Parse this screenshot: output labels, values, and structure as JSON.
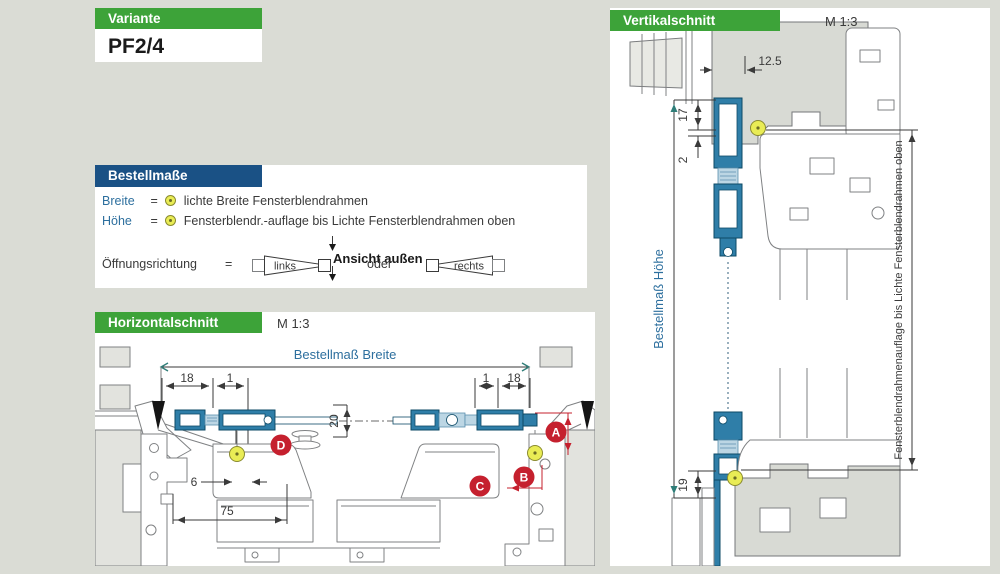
{
  "colors": {
    "page_bg": "#dadcd5",
    "green_header": "#3da339",
    "blue_header": "#1a5185",
    "blue_text": "#2d6f9e",
    "red_badge": "#c5202e",
    "profile_teal": "#2f7ea8",
    "marker_yellow": "#e9ec55"
  },
  "variante": {
    "header": "Variante",
    "value": "PF2/4"
  },
  "bestellmasse": {
    "header": "Bestellmaße",
    "breite_label": "Breite",
    "breite_eq": "=",
    "breite_desc": "lichte Breite Fensterblendrahmen",
    "hoehe_label": "Höhe",
    "hoehe_eq": "=",
    "hoehe_desc": "Fensterblendr.-auflage bis Lichte Fensterblendrahmen oben",
    "oeffnung_label": "Öffnungsrichtung",
    "oeffnung_eq": "=",
    "ansicht_aussen": "Ansicht außen",
    "links": "links",
    "oder": "oder",
    "rechts": "rechts"
  },
  "horizontalschnitt": {
    "header": "Horizontalschnitt",
    "scale": "M 1:3",
    "dim_label": "Bestellmaß Breite",
    "dims": {
      "left18": "18",
      "left1": "1",
      "right1": "1",
      "right18": "18",
      "glass20": "20",
      "gap6": "6",
      "sill75": "75"
    },
    "badges": {
      "a": "A",
      "b": "B",
      "c": "C",
      "d": "D"
    }
  },
  "vertikalschnitt": {
    "header": "Vertikalschnitt",
    "scale": "M 1:3",
    "dim_label": "Bestellmaß Höhe",
    "side_label": "Fensterblendrahmenauflage bis Lichte Fensterblendrahmen oben",
    "dims": {
      "top125": "12.5",
      "d17": "17",
      "d2": "2",
      "d19": "19"
    }
  }
}
